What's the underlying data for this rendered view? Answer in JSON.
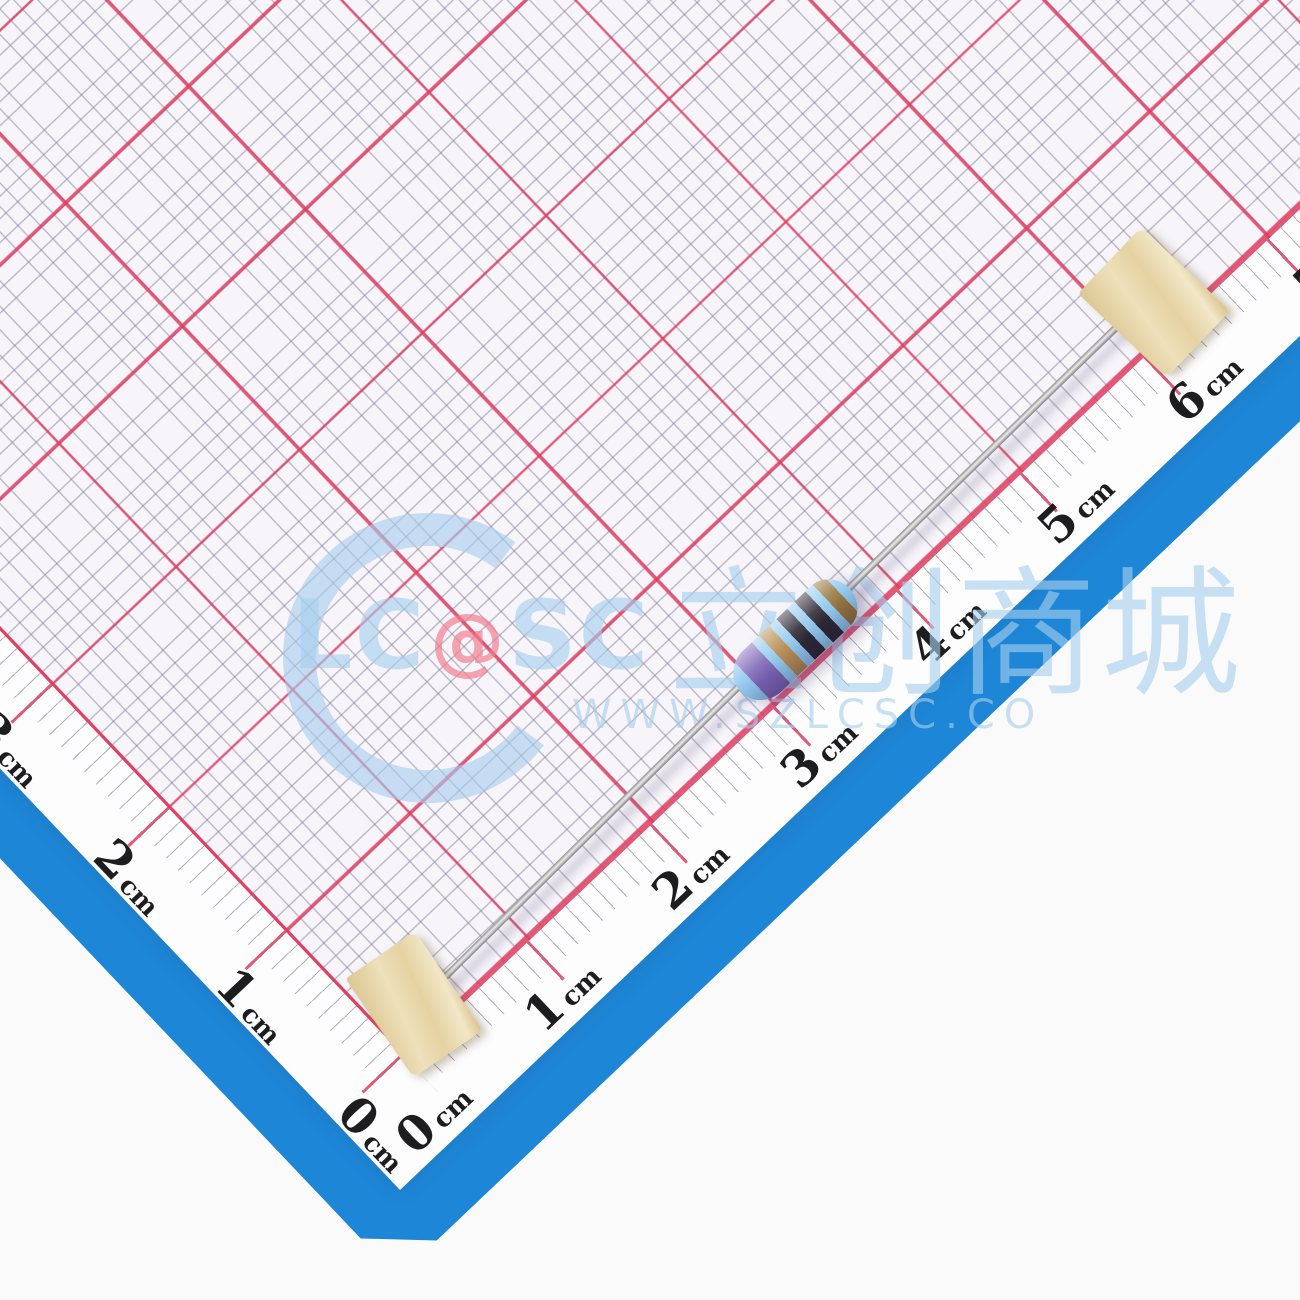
{
  "colors": {
    "backdrop": "#fafafa",
    "blue_mat": "#1e86d7",
    "paper": "#fdfdfd",
    "grid_bg": "#f7f5fa",
    "grid_fine": "rgba(125,120,148,0.6)",
    "grid_red": "rgba(225,60,95,0.85)",
    "label": "#1d1d1f",
    "wm_blue": "rgba(167,206,238,0.62)",
    "wm_red": "rgba(242,122,140,0.68)",
    "tape": "#e9d8ac",
    "lead": "#b9b9b9",
    "resistor_body": "#8fc7ee"
  },
  "ruler": {
    "unit": "cm",
    "bottom_labels": [
      "0",
      "1",
      "2",
      "3",
      "4",
      "5",
      "6",
      "7"
    ],
    "left_labels": [
      "0",
      "1",
      "2",
      "3"
    ]
  },
  "watermark": {
    "logo_prefix": "LC",
    "logo_at": "@",
    "logo_suffix": "SC",
    "logo_cn": "立创商城",
    "url_text": "WWW.SZLCSC.CO"
  },
  "resistor": {
    "body_color": "#8fc7ee",
    "band_colors_named": [
      "violet",
      "gold",
      "black",
      "black",
      "brown"
    ],
    "stripes": [
      [
        "#8fc7ee",
        0,
        16
      ],
      [
        "#7c64b6",
        16,
        42
      ],
      [
        "#93cbf0",
        42,
        52
      ],
      [
        "#b78d50",
        52,
        66
      ],
      [
        "#93cbf0",
        66,
        76
      ],
      [
        "#2c2832",
        76,
        91
      ],
      [
        "#93cbf0",
        91,
        101
      ],
      [
        "#2c2832",
        101,
        116
      ],
      [
        "#93cbf0",
        116,
        126
      ],
      [
        "#96763c",
        126,
        140
      ],
      [
        "#8fc7ee",
        140,
        150
      ]
    ]
  }
}
